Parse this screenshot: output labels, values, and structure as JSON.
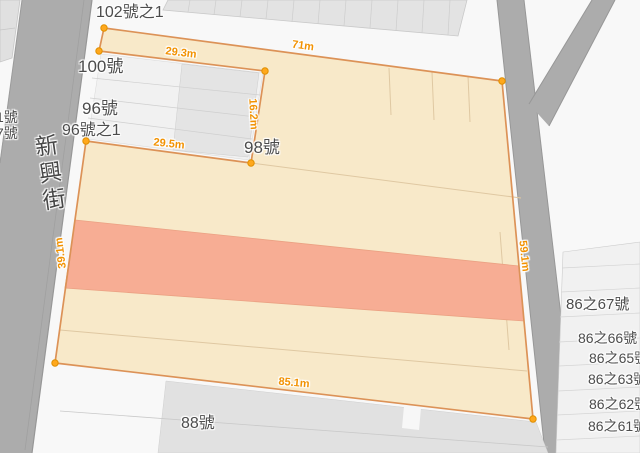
{
  "map": {
    "street_label": "新興街",
    "addresses": [
      {
        "text": "102號之1",
        "x": 96,
        "y": 4,
        "size": 16
      },
      {
        "text": "100號",
        "x": 78,
        "y": 58,
        "size": 17
      },
      {
        "text": "96號",
        "x": 82,
        "y": 100,
        "size": 17
      },
      {
        "text": "96號之1",
        "x": 62,
        "y": 122,
        "size": 16
      },
      {
        "text": "98號",
        "x": 244,
        "y": 139,
        "size": 17
      },
      {
        "text": "88號",
        "x": 181,
        "y": 415,
        "size": 16
      },
      {
        "text": "86之67號",
        "x": 566,
        "y": 297,
        "size": 15
      },
      {
        "text": "86之66號",
        "x": 578,
        "y": 331,
        "size": 14
      },
      {
        "text": "86之65號",
        "x": 589,
        "y": 351,
        "size": 14
      },
      {
        "text": "86之63號",
        "x": 588,
        "y": 372,
        "size": 14
      },
      {
        "text": "86之62號",
        "x": 589,
        "y": 397,
        "size": 14
      },
      {
        "text": "86之61號",
        "x": 588,
        "y": 419,
        "size": 14
      },
      {
        "text": "1號",
        "x": -4,
        "y": 110,
        "size": 14
      },
      {
        "text": "7號",
        "x": -4,
        "y": 126,
        "size": 14
      }
    ],
    "measurements": [
      {
        "text": "29.3m",
        "cx": 181,
        "cy": 53,
        "rot": 7
      },
      {
        "text": "71m",
        "cx": 303,
        "cy": 46,
        "rot": 8
      },
      {
        "text": "16.2m",
        "cx": 253,
        "cy": 114,
        "rot": 87
      },
      {
        "text": "29.5m",
        "cx": 169,
        "cy": 144,
        "rot": 6
      },
      {
        "text": "85.1m",
        "cx": 294,
        "cy": 383,
        "rot": 5
      },
      {
        "text": "39.1m",
        "cx": 61,
        "cy": 253,
        "rot": -97
      },
      {
        "text": "59.1m",
        "cx": 524,
        "cy": 256,
        "rot": 84
      }
    ],
    "parcel": {
      "outline": [
        [
          104,
          28
        ],
        [
          502,
          81
        ],
        [
          533,
          419
        ],
        [
          55,
          363
        ],
        [
          86,
          141
        ],
        [
          251,
          163
        ],
        [
          265,
          71
        ],
        [
          99,
          51
        ]
      ],
      "highlight_band": [
        [
          75,
          220
        ],
        [
          519,
          266
        ],
        [
          524,
          321
        ],
        [
          65,
          288
        ]
      ],
      "inner_lines": [
        [
          [
            251,
            163
          ],
          [
            521,
            198
          ]
        ],
        [
          [
            60,
            330
          ],
          [
            527,
            371
          ]
        ],
        [
          [
            389,
            68
          ],
          [
            391,
            115
          ]
        ],
        [
          [
            432,
            72
          ],
          [
            434,
            120
          ]
        ],
        [
          [
            468,
            76
          ],
          [
            470,
            122
          ]
        ],
        [
          [
            500,
            232
          ],
          [
            509,
            350
          ]
        ]
      ],
      "vertices": [
        [
          104,
          28
        ],
        [
          99,
          51
        ],
        [
          265,
          71
        ],
        [
          86,
          141
        ],
        [
          251,
          163
        ],
        [
          502,
          81
        ],
        [
          533,
          419
        ],
        [
          55,
          363
        ]
      ],
      "fill": "#f8e9c9",
      "band_fill": "#f7ad94",
      "band_stroke": "#eba183",
      "stroke": "#dc9257",
      "inner_line_color": "#dfc8a2",
      "marker_fill": "#ffa81c",
      "marker_stroke": "#e08f00"
    },
    "colors": {
      "background": "#f8f8f8",
      "road": "#acacac",
      "road_edge": "#979797",
      "building": "#e3e3e3",
      "building_light": "#f1f1f1",
      "address_text": "#4c4c4c",
      "measure_text": "#f29202"
    }
  }
}
